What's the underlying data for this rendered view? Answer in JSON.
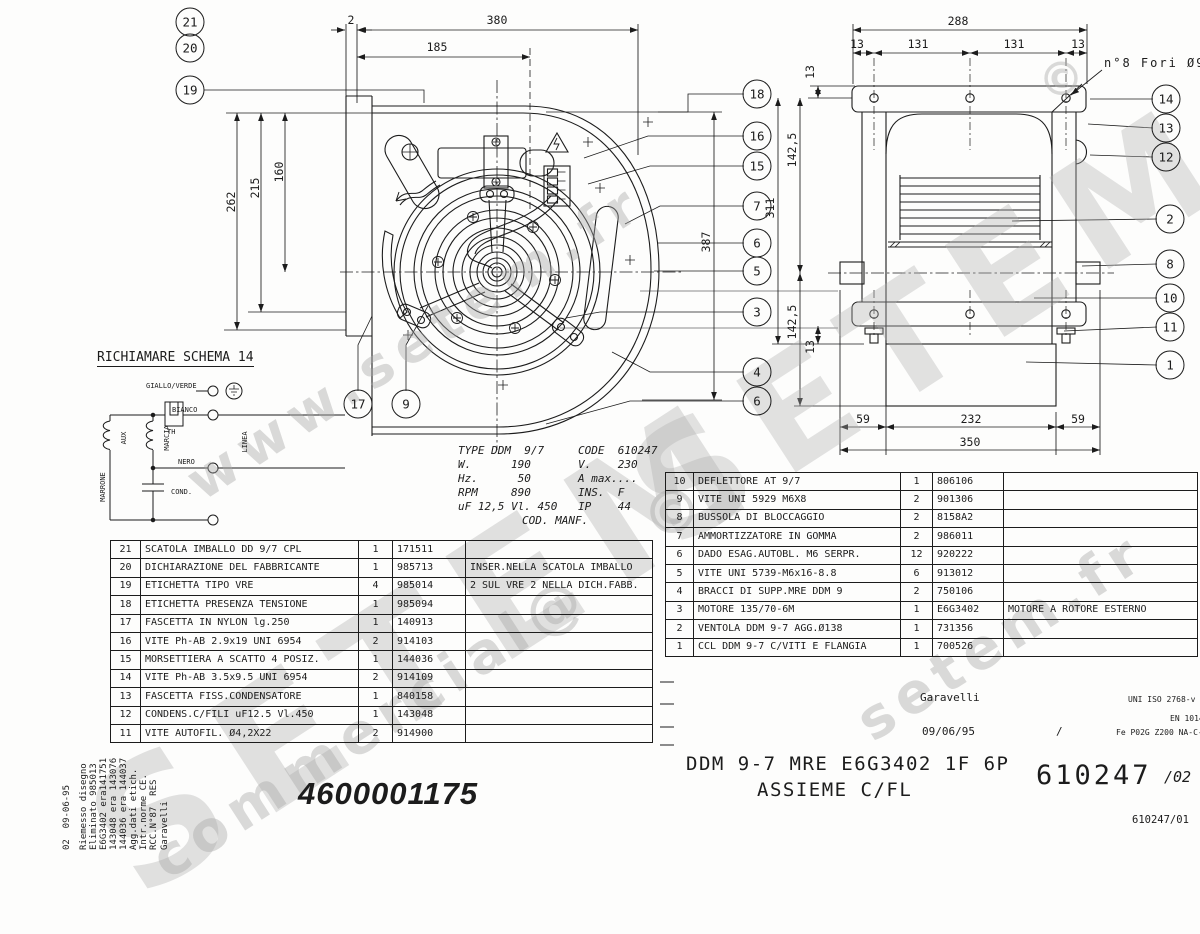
{
  "watermarks": {
    "w_www": "www.setem.fr",
    "w_setem_big": "SETEM",
    "w_setem_top": "SETEM®",
    "w_fr": "setem.fr",
    "w_commercial": "commercial@",
    "w_copy1": "©",
    "w_copy2": "©"
  },
  "dims": {
    "front_gap": "2",
    "front_width": "380",
    "front_cap": "185",
    "front_h1": "160",
    "front_h2": "215",
    "front_h3": "262",
    "front_height": "387",
    "side_top": "288",
    "side_e1": "13",
    "side_s1": "131",
    "side_s2": "131",
    "side_e2": "13",
    "side_v13t": "13",
    "side_v142a": "142,5",
    "side_v311": "311",
    "side_v142b": "142,5",
    "side_v13b": "13",
    "foot_l": "59",
    "foot_c": "232",
    "foot_r": "59",
    "foot_total": "350",
    "holes_note": "n°8 Fori Ø9"
  },
  "balloons": [
    {
      "n": "21",
      "x": 190,
      "y": 22
    },
    {
      "n": "20",
      "x": 190,
      "y": 48
    },
    {
      "n": "19",
      "x": 190,
      "y": 90
    },
    {
      "n": "17",
      "x": 358,
      "y": 404
    },
    {
      "n": "9",
      "x": 406,
      "y": 404
    },
    {
      "n": "18",
      "x": 757,
      "y": 94
    },
    {
      "n": "16",
      "x": 757,
      "y": 136
    },
    {
      "n": "15",
      "x": 757,
      "y": 166
    },
    {
      "n": "7",
      "x": 757,
      "y": 206
    },
    {
      "n": "6",
      "x": 757,
      "y": 243
    },
    {
      "n": "5",
      "x": 757,
      "y": 271
    },
    {
      "n": "3",
      "x": 757,
      "y": 312
    },
    {
      "n": "4",
      "x": 757,
      "y": 372
    },
    {
      "n": "6",
      "x": 757,
      "y": 401
    },
    {
      "n": "14",
      "x": 1166,
      "y": 99
    },
    {
      "n": "13",
      "x": 1166,
      "y": 128
    },
    {
      "n": "12",
      "x": 1166,
      "y": 157
    },
    {
      "n": "2",
      "x": 1170,
      "y": 219
    },
    {
      "n": "8",
      "x": 1170,
      "y": 264
    },
    {
      "n": "10",
      "x": 1170,
      "y": 298
    },
    {
      "n": "11",
      "x": 1170,
      "y": 327
    },
    {
      "n": "1",
      "x": 1170,
      "y": 365
    }
  ],
  "wiring": {
    "title": "RICHIAMARE SCHEMA 14",
    "giallo": "GIALLO/VERDE",
    "bianco": "BIANCO",
    "nero": "NERO",
    "th": "TH",
    "aux": "AUX",
    "marcia": "MARCIA",
    "linea": "LINEA",
    "marrone": "MARRONE",
    "cond": "COND."
  },
  "type_plate": {
    "left": "TYPE DDM  9/7\nW.      190\nHz.      50\nRPM     890\nuF 12,5 Vl. 450",
    "right": "CODE  610247\nV.    230\nA max....\nINS.  F\nIP    44",
    "footer": "COD. MANF."
  },
  "parts_left": {
    "rows": [
      {
        "item": "21",
        "desc": "SCATOLA IMBALLO DD 9/7 CPL",
        "qty": "1",
        "code": "171511",
        "note": ""
      },
      {
        "item": "20",
        "desc": "DICHIARAZIONE DEL FABBRICANTE",
        "qty": "1",
        "code": "985713",
        "note": "INSER.NELLA SCATOLA IMBALLO"
      },
      {
        "item": "19",
        "desc": "ETICHETTA TIPO VRE",
        "qty": "4",
        "code": "985014",
        "note": "2 SUL VRE 2 NELLA DICH.FABB."
      },
      {
        "item": "18",
        "desc": "ETICHETTA PRESENZA TENSIONE",
        "qty": "1",
        "code": "985094",
        "note": ""
      },
      {
        "item": "17",
        "desc": "FASCETTA IN NYLON lg.250",
        "qty": "1",
        "code": "140913",
        "note": ""
      },
      {
        "item": "16",
        "desc": "VITE Ph-AB 2.9x19 UNI 6954",
        "qty": "2",
        "code": "914103",
        "note": ""
      },
      {
        "item": "15",
        "desc": "MORSETTIERA A SCATTO 4 POSIZ.",
        "qty": "1",
        "code": "144036",
        "note": ""
      },
      {
        "item": "14",
        "desc": "VITE Ph-AB 3.5x9.5 UNI 6954",
        "qty": "2",
        "code": "914109",
        "note": ""
      },
      {
        "item": "13",
        "desc": "FASCETTA FISS.CONDENSATORE",
        "qty": "1",
        "code": "840158",
        "note": ""
      },
      {
        "item": "12",
        "desc": "CONDENS.C/FILI uF12.5 Vl.450",
        "qty": "1",
        "code": "143048",
        "note": ""
      },
      {
        "item": "11",
        "desc": "VITE AUTOFIL. Ø4,2X22",
        "qty": "2",
        "code": "914900",
        "note": ""
      }
    ]
  },
  "parts_right": {
    "rows": [
      {
        "item": "10",
        "desc": "DEFLETTORE AT 9/7",
        "qty": "1",
        "code": "806106",
        "note": ""
      },
      {
        "item": "9",
        "desc": "VITE UNI 5929 M6X8",
        "qty": "2",
        "code": "901306",
        "note": ""
      },
      {
        "item": "8",
        "desc": "BUSSOLA DI BLOCCAGGIO",
        "qty": "2",
        "code": "8158A2",
        "note": ""
      },
      {
        "item": "7",
        "desc": "AMMORTIZZATORE IN GOMMA",
        "qty": "2",
        "code": "986011",
        "note": ""
      },
      {
        "item": "6",
        "desc": "DADO ESAG.AUTOBL. M6 SERPR.",
        "qty": "12",
        "code": "920222",
        "note": ""
      },
      {
        "item": "5",
        "desc": "VITE UNI 5739-M6x16-8.8",
        "qty": "6",
        "code": "913012",
        "note": ""
      },
      {
        "item": "4",
        "desc": "BRACCI DI SUPP.MRE DDM 9",
        "qty": "2",
        "code": "750106",
        "note": ""
      },
      {
        "item": "3",
        "desc": "MOTORE 135/70-6M",
        "qty": "1",
        "code": "E6G3402",
        "note": "MOTORE A ROTORE ESTERNO"
      },
      {
        "item": "2",
        "desc": "VENTOLA DDM 9-7 AGG.Ø138",
        "qty": "1",
        "code": "731356",
        "note": ""
      },
      {
        "item": "1",
        "desc": "CCL DDM 9-7 C/VITI E FLANGIA",
        "qty": "1",
        "code": "700526",
        "note": ""
      }
    ]
  },
  "title_block": {
    "author": "Garavelli",
    "date": "09/06/95",
    "sep": "/",
    "std_a": "UNI ISO 2768-v",
    "std_b": "EN 1014",
    "material": "Fe P02G Z200 NA-C-",
    "title1": "DDM 9-7 MRE E6G3402 1F 6P",
    "title2": "ASSIEME C/FL",
    "code_big": "610247",
    "rev_big": "/02",
    "doc_ref": "610247/01",
    "part_number": "4600001175"
  },
  "revisions": {
    "lines": [
      "02  09-06-95",
      "Riemesso disegno",
      "Eliminato 985013",
      "E6G3402 era141751",
      "143048 era 143076",
      "144036 era 144037",
      "Agg.dati etich.",
      "Intr.norme CE.",
      "RCC.N°87  RES",
      "Garavelli"
    ]
  }
}
